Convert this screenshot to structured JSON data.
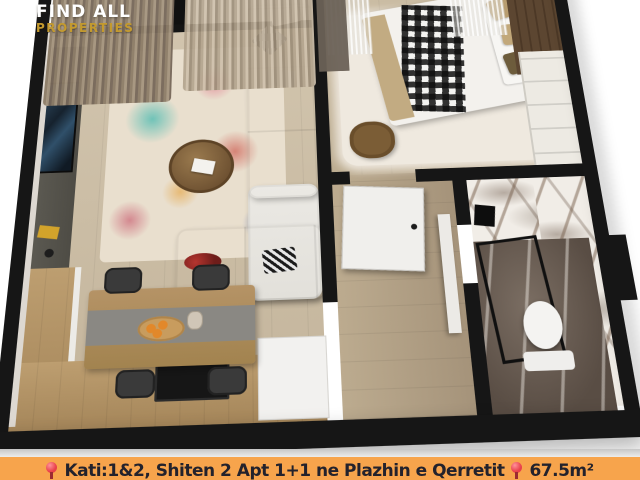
{
  "colors": {
    "bar-orange": "#f7a44c",
    "gold": "#c49a2e",
    "logo-white": "#ffffff",
    "pin-red": "#e8404a",
    "caption-text": "#23222c",
    "wall-black": "#161616"
  },
  "logo": {
    "line1": "FIND ALL",
    "line2": "PROPERTIES"
  },
  "caption": {
    "location_part": "Kati:1&2,  Shiten 2 Apt 1+1 ne Plazhin e Qerretit",
    "area_part": "67.5m²"
  },
  "floorplan": {
    "type": "3d-apartment-floor-plan",
    "rooms": [
      {
        "name": "living-room",
        "features": [
          "tv-console",
          "tv",
          "sectional-sofa",
          "pillows",
          "coffee-table",
          "colorful-rug",
          "curtains",
          "windows"
        ]
      },
      {
        "name": "kitchen-dining",
        "features": [
          "wood-counter",
          "stove",
          "dining-table",
          "table-runner",
          "fruit-plate",
          "chairs",
          "white-appliance"
        ]
      },
      {
        "name": "bedroom",
        "features": [
          "double-bed",
          "plaid-throw",
          "tan-pillows",
          "shag-rug",
          "armchair",
          "wardrobe",
          "nightstand",
          "gold-lamp",
          "headboard-wall",
          "sheer-curtains"
        ]
      },
      {
        "name": "hallway",
        "features": [
          "white-door",
          "door-panel",
          "wood-floor"
        ]
      },
      {
        "name": "bathroom",
        "features": [
          "marble-walls",
          "marble-floor",
          "toilet",
          "shower-partition"
        ]
      },
      {
        "name": "balcony",
        "features": [
          "wood-deck",
          "stool"
        ]
      }
    ]
  }
}
